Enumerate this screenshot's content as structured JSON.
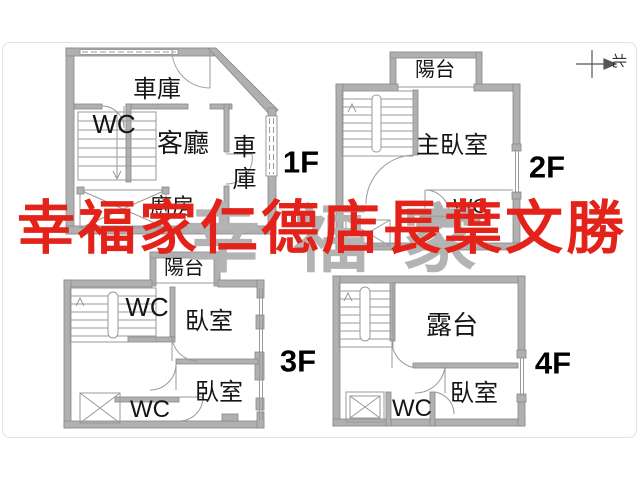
{
  "watermark": {
    "text": "幸福家仁德店長葉文勝",
    "color": "#e3231a",
    "secondary_text": "幸福家",
    "secondary_color": "#b3b3b3"
  },
  "compass": {
    "north": "北"
  },
  "floors": {
    "f1": {
      "label": "1F",
      "garage_top": "車庫",
      "wc": "WC",
      "living": "客廳",
      "garage_side": "車庫",
      "kitchen": "廚房"
    },
    "f2": {
      "label": "2F",
      "balcony": "陽台",
      "master_bedroom": "主臥室",
      "wc": "WC"
    },
    "f3": {
      "label": "3F",
      "balcony": "陽台",
      "wc_upper": "WC",
      "bedroom_upper": "臥室",
      "bedroom_lower": "臥室",
      "wc_lower": "WC"
    },
    "f4": {
      "label": "4F",
      "terrace": "露台",
      "bedroom": "臥室",
      "wc": "WC"
    }
  }
}
